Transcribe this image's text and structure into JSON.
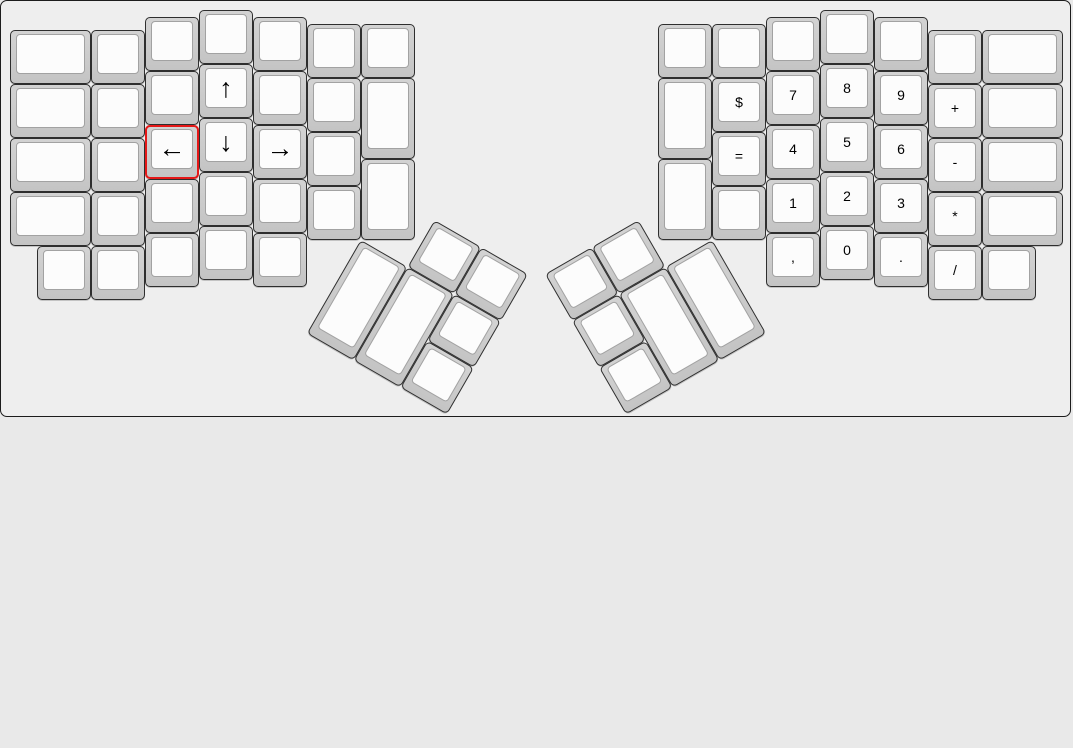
{
  "app": {
    "description": "keyboard layout editor canvas showing an ErgoDox split keyboard",
    "board_background": "#eeeeee",
    "board_border_color": "#1c1c1c",
    "page_background": "#e9e9e9",
    "key_base_color": "#cccccc",
    "key_top_color": "#fcfcfc",
    "selected_outline_color": "#e51717",
    "selected_key": "←"
  },
  "groups": [
    {
      "name": "left-hand-keywell",
      "r": 0,
      "rx": 0,
      "ry": 0,
      "keys": [
        {
          "x": 0,
          "y": 0.375,
          "w": 1.5,
          "h": 1,
          "label": ""
        },
        {
          "x": 0,
          "y": 1.375,
          "w": 1.5,
          "h": 1,
          "label": ""
        },
        {
          "x": 0,
          "y": 2.375,
          "w": 1.5,
          "h": 1,
          "label": ""
        },
        {
          "x": 0,
          "y": 3.375,
          "w": 1.5,
          "h": 1,
          "label": ""
        },
        {
          "x": 1.5,
          "y": 0.375,
          "w": 1,
          "h": 1,
          "label": ""
        },
        {
          "x": 1.5,
          "y": 1.375,
          "w": 1,
          "h": 1,
          "label": ""
        },
        {
          "x": 1.5,
          "y": 2.375,
          "w": 1,
          "h": 1,
          "label": ""
        },
        {
          "x": 1.5,
          "y": 3.375,
          "w": 1,
          "h": 1,
          "label": ""
        },
        {
          "x": 2.5,
          "y": 0.125,
          "w": 1,
          "h": 1,
          "label": ""
        },
        {
          "x": 2.5,
          "y": 1.125,
          "w": 1,
          "h": 1,
          "label": ""
        },
        {
          "x": 2.5,
          "y": 2.125,
          "w": 1,
          "h": 1,
          "label": "←",
          "selected": true
        },
        {
          "x": 2.5,
          "y": 3.125,
          "w": 1,
          "h": 1,
          "label": ""
        },
        {
          "x": 3.5,
          "y": 0,
          "w": 1,
          "h": 1,
          "label": ""
        },
        {
          "x": 3.5,
          "y": 1,
          "w": 1,
          "h": 1,
          "label": "↑"
        },
        {
          "x": 3.5,
          "y": 2,
          "w": 1,
          "h": 1,
          "label": "↓"
        },
        {
          "x": 3.5,
          "y": 3,
          "w": 1,
          "h": 1,
          "label": ""
        },
        {
          "x": 4.5,
          "y": 0.125,
          "w": 1,
          "h": 1,
          "label": ""
        },
        {
          "x": 4.5,
          "y": 1.125,
          "w": 1,
          "h": 1,
          "label": ""
        },
        {
          "x": 4.5,
          "y": 2.125,
          "w": 1,
          "h": 1,
          "label": "→"
        },
        {
          "x": 4.5,
          "y": 3.125,
          "w": 1,
          "h": 1,
          "label": ""
        },
        {
          "x": 5.5,
          "y": 0.25,
          "w": 1,
          "h": 1,
          "label": ""
        },
        {
          "x": 5.5,
          "y": 1.25,
          "w": 1,
          "h": 1,
          "label": ""
        },
        {
          "x": 5.5,
          "y": 2.25,
          "w": 1,
          "h": 1,
          "label": ""
        },
        {
          "x": 5.5,
          "y": 3.25,
          "w": 1,
          "h": 1,
          "label": ""
        },
        {
          "x": 6.5,
          "y": 0.25,
          "w": 1,
          "h": 1,
          "label": ""
        },
        {
          "x": 6.5,
          "y": 1.25,
          "w": 1,
          "h": 1.5,
          "label": ""
        },
        {
          "x": 6.5,
          "y": 2.75,
          "w": 1,
          "h": 1.5,
          "label": ""
        },
        {
          "x": 0.5,
          "y": 4.375,
          "w": 1,
          "h": 1,
          "label": ""
        },
        {
          "x": 1.5,
          "y": 4.375,
          "w": 1,
          "h": 1,
          "label": ""
        },
        {
          "x": 2.5,
          "y": 4.125,
          "w": 1,
          "h": 1,
          "label": ""
        },
        {
          "x": 3.5,
          "y": 4,
          "w": 1,
          "h": 1,
          "label": ""
        },
        {
          "x": 4.5,
          "y": 4.125,
          "w": 1,
          "h": 1,
          "label": ""
        }
      ]
    },
    {
      "name": "left-thumb-cluster",
      "r": 30,
      "rx": 6.5,
      "ry": 4.25,
      "keys": [
        {
          "x": 7.5,
          "y": 3.25,
          "w": 1,
          "h": 1,
          "label": ""
        },
        {
          "x": 8.5,
          "y": 3.25,
          "w": 1,
          "h": 1,
          "label": ""
        },
        {
          "x": 6.5,
          "y": 4.25,
          "w": 1,
          "h": 2,
          "label": ""
        },
        {
          "x": 7.5,
          "y": 4.25,
          "w": 1,
          "h": 2,
          "label": ""
        },
        {
          "x": 8.5,
          "y": 4.25,
          "w": 1,
          "h": 1,
          "label": ""
        },
        {
          "x": 8.5,
          "y": 5.25,
          "w": 1,
          "h": 1,
          "label": ""
        }
      ]
    },
    {
      "name": "right-hand-keywell",
      "r": 0,
      "rx": 0,
      "ry": 0,
      "keys": [
        {
          "x": 12,
          "y": 0.25,
          "w": 1,
          "h": 1,
          "label": ""
        },
        {
          "x": 12,
          "y": 1.25,
          "w": 1,
          "h": 1.5,
          "label": ""
        },
        {
          "x": 12,
          "y": 2.75,
          "w": 1,
          "h": 1.5,
          "label": ""
        },
        {
          "x": 13,
          "y": 0.25,
          "w": 1,
          "h": 1,
          "label": ""
        },
        {
          "x": 13,
          "y": 1.25,
          "w": 1,
          "h": 1,
          "label": "$"
        },
        {
          "x": 13,
          "y": 2.25,
          "w": 1,
          "h": 1,
          "label": "="
        },
        {
          "x": 13,
          "y": 3.25,
          "w": 1,
          "h": 1,
          "label": ""
        },
        {
          "x": 14,
          "y": 0.125,
          "w": 1,
          "h": 1,
          "label": ""
        },
        {
          "x": 14,
          "y": 1.125,
          "w": 1,
          "h": 1,
          "label": "7"
        },
        {
          "x": 14,
          "y": 2.125,
          "w": 1,
          "h": 1,
          "label": "4"
        },
        {
          "x": 14,
          "y": 3.125,
          "w": 1,
          "h": 1,
          "label": "1"
        },
        {
          "x": 14,
          "y": 4.125,
          "w": 1,
          "h": 1,
          "label": ","
        },
        {
          "x": 15,
          "y": 0,
          "w": 1,
          "h": 1,
          "label": ""
        },
        {
          "x": 15,
          "y": 1,
          "w": 1,
          "h": 1,
          "label": "8"
        },
        {
          "x": 15,
          "y": 2,
          "w": 1,
          "h": 1,
          "label": "5"
        },
        {
          "x": 15,
          "y": 3,
          "w": 1,
          "h": 1,
          "label": "2"
        },
        {
          "x": 15,
          "y": 4,
          "w": 1,
          "h": 1,
          "label": "0"
        },
        {
          "x": 16,
          "y": 0.125,
          "w": 1,
          "h": 1,
          "label": ""
        },
        {
          "x": 16,
          "y": 1.125,
          "w": 1,
          "h": 1,
          "label": "9"
        },
        {
          "x": 16,
          "y": 2.125,
          "w": 1,
          "h": 1,
          "label": "6"
        },
        {
          "x": 16,
          "y": 3.125,
          "w": 1,
          "h": 1,
          "label": "3"
        },
        {
          "x": 16,
          "y": 4.125,
          "w": 1,
          "h": 1,
          "label": "."
        },
        {
          "x": 17,
          "y": 0.375,
          "w": 1,
          "h": 1,
          "label": ""
        },
        {
          "x": 17,
          "y": 1.375,
          "w": 1,
          "h": 1,
          "label": "+"
        },
        {
          "x": 17,
          "y": 2.375,
          "w": 1,
          "h": 1,
          "label": "-"
        },
        {
          "x": 17,
          "y": 3.375,
          "w": 1,
          "h": 1,
          "label": "*"
        },
        {
          "x": 17,
          "y": 4.375,
          "w": 1,
          "h": 1,
          "label": "/"
        },
        {
          "x": 18,
          "y": 0.375,
          "w": 1.5,
          "h": 1,
          "label": ""
        },
        {
          "x": 18,
          "y": 1.375,
          "w": 1.5,
          "h": 1,
          "label": ""
        },
        {
          "x": 18,
          "y": 2.375,
          "w": 1.5,
          "h": 1,
          "label": ""
        },
        {
          "x": 18,
          "y": 3.375,
          "w": 1.5,
          "h": 1,
          "label": ""
        },
        {
          "x": 18,
          "y": 4.375,
          "w": 1,
          "h": 1,
          "label": ""
        }
      ]
    },
    {
      "name": "right-thumb-cluster",
      "r": -30,
      "rx": 13,
      "ry": 4.25,
      "keys": [
        {
          "x": 10,
          "y": 3.25,
          "w": 1,
          "h": 1,
          "label": ""
        },
        {
          "x": 11,
          "y": 3.25,
          "w": 1,
          "h": 1,
          "label": ""
        },
        {
          "x": 11,
          "y": 4.25,
          "w": 1,
          "h": 2,
          "label": ""
        },
        {
          "x": 12,
          "y": 4.25,
          "w": 1,
          "h": 2,
          "label": ""
        },
        {
          "x": 10,
          "y": 4.25,
          "w": 1,
          "h": 1,
          "label": ""
        },
        {
          "x": 10,
          "y": 5.25,
          "w": 1,
          "h": 1,
          "label": ""
        }
      ]
    }
  ]
}
